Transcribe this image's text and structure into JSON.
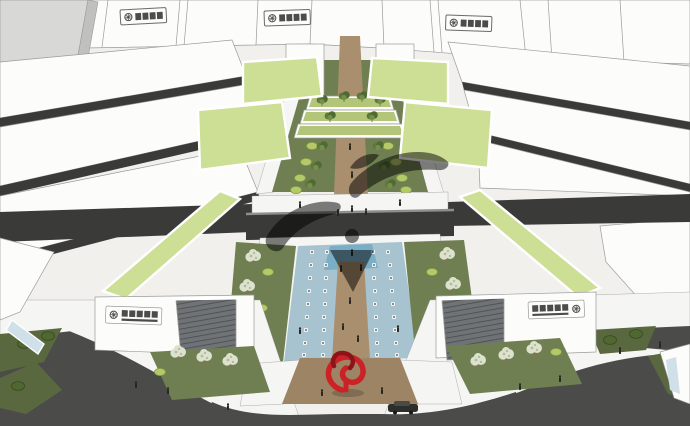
{
  "scene": {
    "kind": "aerial-architectural-rendering",
    "roof_signs": 3,
    "facade_signs": 2,
    "green_roofs": 6,
    "vehicles": 1,
    "sculptures": 1,
    "water_channels": 2
  },
  "watermark": {
    "icon": "swirl-emblem",
    "opacity": "0.5"
  },
  "colors": {
    "bg": "#f1f0ed",
    "white_bldg": "#fcfcfb",
    "bldg_shade": "#ebebe8",
    "bldg_edge": "#9b9b99",
    "gray_bldg": "#d8d8d6",
    "gray_bldg_side": "#c0c0be",
    "roof_green": "#cdde95",
    "terrace_green": "#b3c578",
    "lawn": "#6f7f52",
    "lawn_dark": "#59683f",
    "shrub_light": "#b6c968",
    "shrub_dark": "#50682f",
    "tree_green": "#5d7a3a",
    "tree_pale": "#dde2cf",
    "tree_pale_speckle": "#b3bd9b",
    "trunk": "#8a7156",
    "path_tan": "#a98f6d",
    "plaza_tan": "#9c8465",
    "water_light": "#a6c3cf",
    "water_mid": "#79aec6",
    "white_walk": "#f5f5f3",
    "asphalt": "#4b4b49",
    "corridor_dark": "#3a3a38",
    "bridge_top": "#8f8f8d",
    "ribbed_base": "#6f7375",
    "ribbed_line": "#4b5052",
    "grid_base": "#5c6063",
    "grid_line": "#3e4346",
    "sculpture_red": "#cb2127",
    "sculpture_red_dark": "#8e1318",
    "sign_bg": "#fdfdfc",
    "sign_ink": "#4c4c4a",
    "person_dark": "#262624",
    "car_dark": "#2e2e2c",
    "glass_blue": "#cfe0e8"
  }
}
